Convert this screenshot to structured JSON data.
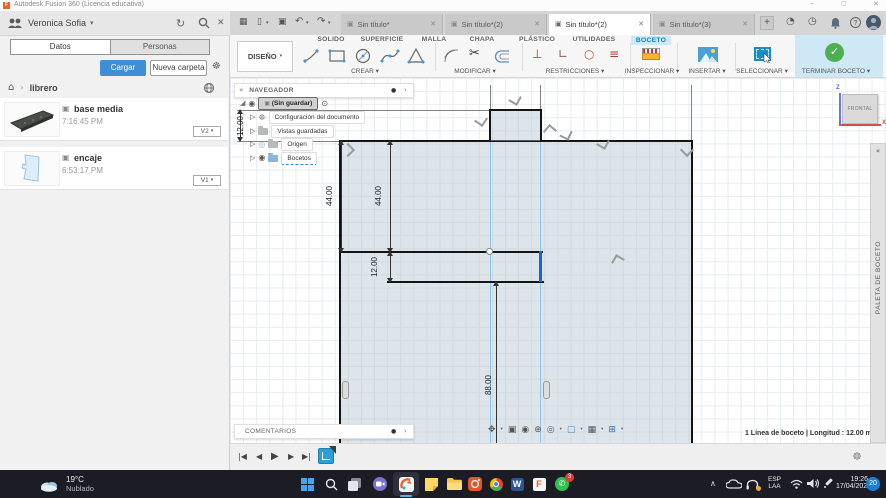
{
  "icons": {
    "caret_down": "▾",
    "chevron_right": "›",
    "collapse_double": "«",
    "close": "✕",
    "minimize": "–",
    "maximize": "▢",
    "plus": "+",
    "grid": "▦",
    "file": "▯",
    "save": "▣",
    "undo": "↶",
    "redo": "↷",
    "refresh": "↻",
    "gear": "☸",
    "home": "⌂",
    "cube": "▣",
    "eye": "◉",
    "eye_off": "◎",
    "expander": "▷",
    "corner": "◢",
    "radio": "⊙",
    "dot": "●",
    "question": "?",
    "job_status": "◔",
    "clock": "◷",
    "scissors": "✂",
    "perpendicular": "⊥",
    "angle": "∟",
    "circle": "○",
    "equal": "≡",
    "chevron_up": "∧",
    "check": "✓",
    "phone": "✆"
  },
  "window": {
    "title": "Autodesk Fusion 360 (Licencia educativa)",
    "logo_letter": "F"
  },
  "data_panel": {
    "user": "Veronica Sofia",
    "tab_datos": "Datos",
    "tab_personas": "Personas",
    "upload_button": "Cargar",
    "new_folder_button": "Nueva carpeta",
    "breadcrumb": "librero",
    "files": [
      {
        "name": "base media",
        "time": "7:16:45 PM",
        "version": "V2"
      },
      {
        "name": "encaje",
        "time": "6:53:17 PM",
        "version": "V1"
      }
    ]
  },
  "document_tabs": [
    "Sin título*",
    "Sin título*(2)",
    "Sin título*(2)",
    "Sin título*(3)"
  ],
  "ribbon": {
    "design_menu": "DISEÑO",
    "tabs": [
      "SOLIDO",
      "SUPERFICIE",
      "MALLA",
      "CHAPA",
      "PLÁSTICO",
      "UTILIDADES",
      "BOCETO"
    ],
    "sections": {
      "crear": "CREAR",
      "modificar": "MODIFICAR",
      "restricciones": "RESTRICCIONES",
      "inspeccionar": "INSPECCIONAR",
      "insertar": "INSERTAR",
      "seleccionar": "SELECCIONAR",
      "terminar_boceto": "TERMINAR BOCETO"
    }
  },
  "navigator": {
    "title": "NAVEGADOR",
    "root": "(Sin guardar)",
    "items": [
      "Configuración del documento",
      "Vistas guardadas",
      "Origen",
      "Bocetos"
    ]
  },
  "sketch": {
    "dim_tab_height": "12.00",
    "dim_upper_left": "44.00",
    "dim_upper_inner": "44.00",
    "dim_step": "12.00",
    "dim_lower": "88.00"
  },
  "canvas": {
    "comments_title": "COMENTARIOS",
    "status_text": "1 Línea de boceto | Longitud : 12.00 mm",
    "viewcube": {
      "face": "FRONTAL",
      "axis_z": "Z",
      "axis_x": "X"
    },
    "palette_title": "PALETA DE BOCETO",
    "nav_icons": [
      "✥",
      "▣",
      "◉",
      "⊕",
      "◎",
      "▢",
      "▦",
      "⊞"
    ]
  },
  "timeline": {
    "controls": [
      "|◀",
      "◀",
      "▶",
      "▶",
      "▶|"
    ]
  },
  "taskbar": {
    "weather": {
      "temp": "19°C",
      "condition": "Nublado"
    },
    "word_letter": "W",
    "f_letter": "F",
    "language": {
      "line1": "ESP",
      "line2": "LAA"
    },
    "clock": {
      "time": "19:26",
      "date": "17/04/2022"
    },
    "notification_badge": "20",
    "whatsapp_badge": "3"
  }
}
